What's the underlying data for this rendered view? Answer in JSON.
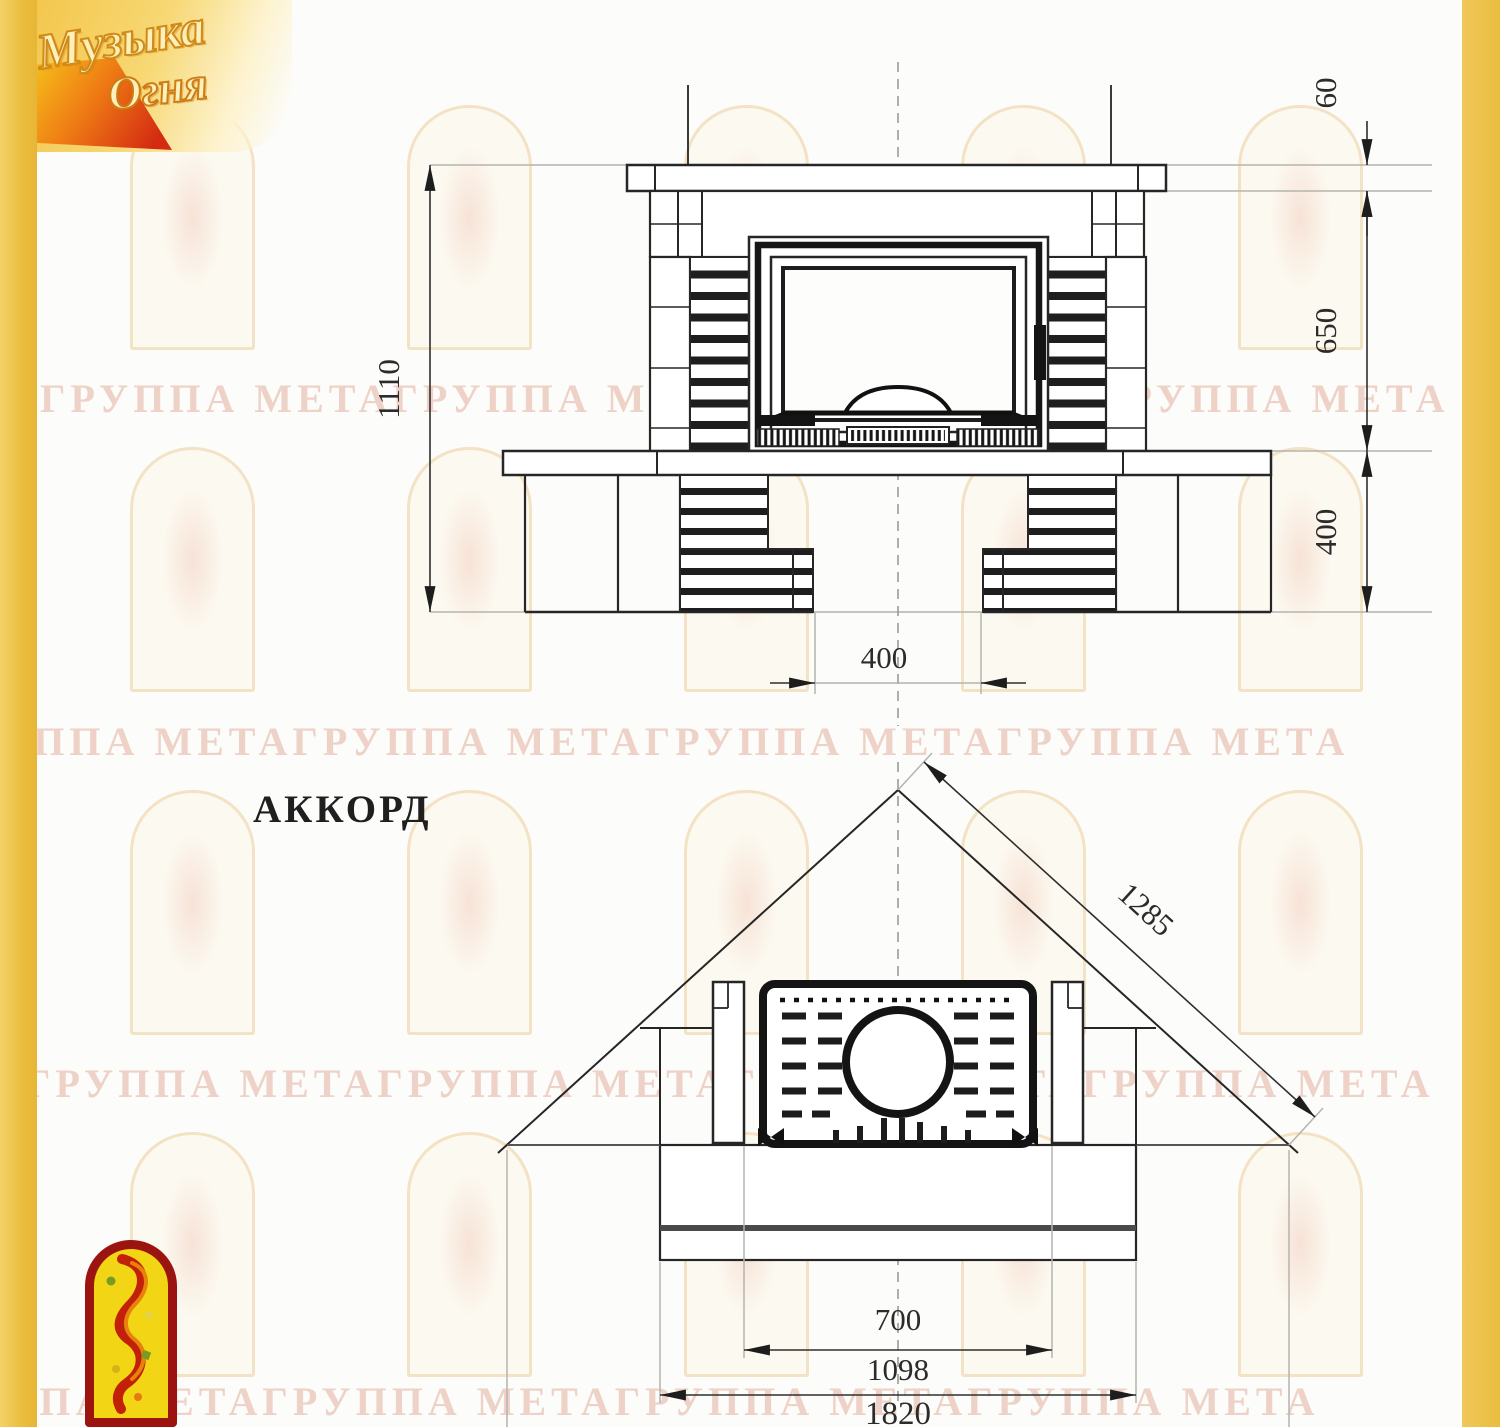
{
  "brand": {
    "line1": "Музыка",
    "line2": "Огня"
  },
  "drawing_title": "АККОРД",
  "front_view": {
    "dims": {
      "total_height": "1110",
      "mantel_thickness": "60",
      "middle_height": "650",
      "base_height": "400",
      "niche_width": "400"
    }
  },
  "plan_view": {
    "dims": {
      "diagonal_depth": "1285",
      "opening_width": "700",
      "hearth_width": "1098",
      "total_width": "1820"
    }
  },
  "watermark": {
    "text": "ГРУППА МЕТАГРУППА МЕТАГРУППА МЕТАГРУППА МЕТА"
  },
  "colors": {
    "side_bar": "#eabd3e",
    "line_dark": "#262626",
    "line_gray": "#b4b4ae",
    "watermark_pink": "#e9c4b6"
  }
}
